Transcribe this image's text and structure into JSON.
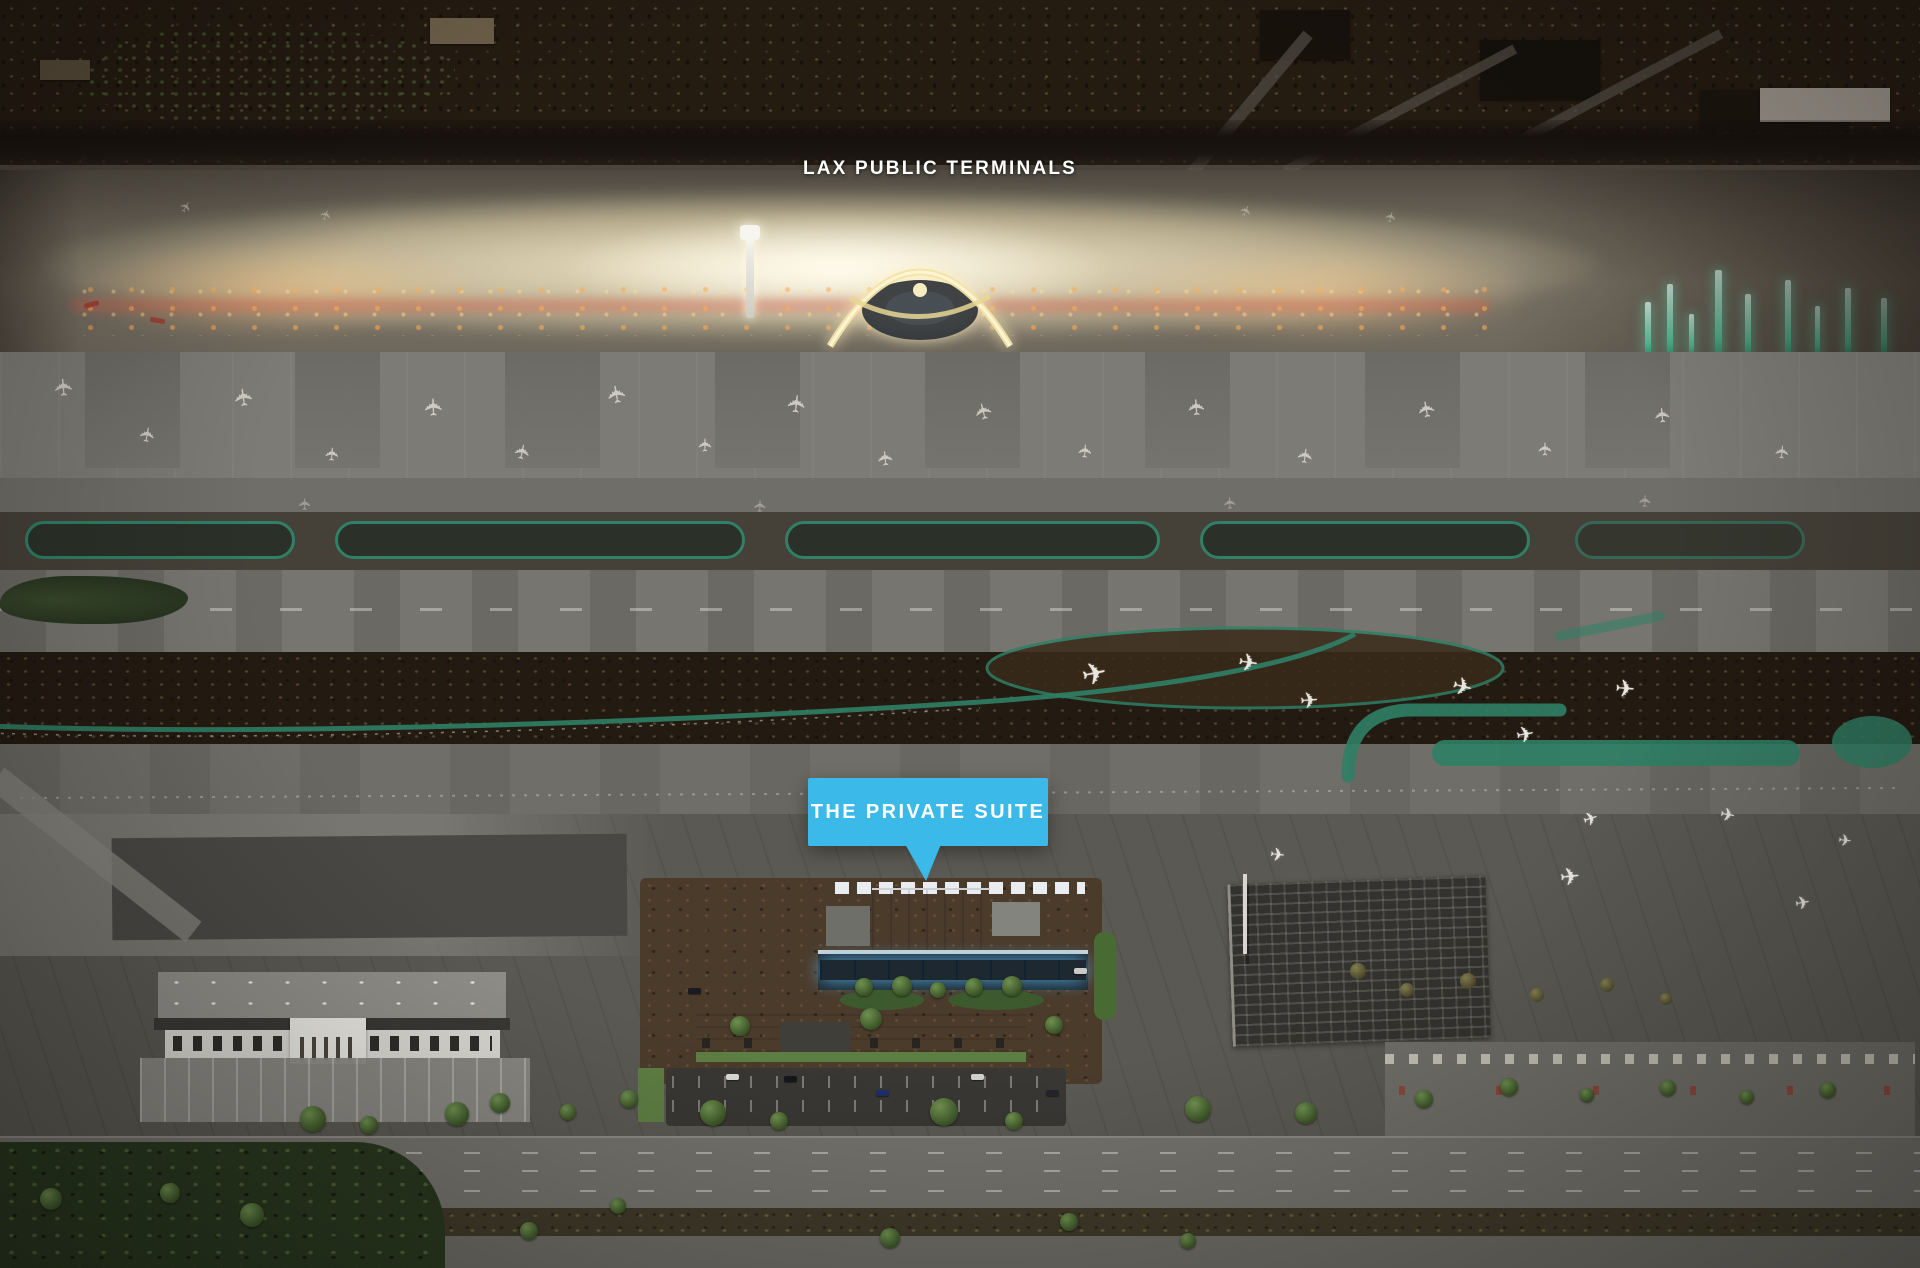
{
  "scene": {
    "type": "aerial-photograph",
    "subject": "Night aerial view of LAX airport with the public terminals in the distance and The Private Suite terminal highlighted in the foreground"
  },
  "annotations": {
    "public_terminals_label": "LAX PUBLIC TERMINALS",
    "private_suite_callout": "THE PRIVATE SUITE"
  },
  "icons": {
    "airplane": "✈"
  },
  "colors": {
    "callout_blue": "#3bb9e9",
    "label_white": "#ffffff",
    "terminal_glow": "#ffeec2",
    "taxiway_teal": "#2f8066",
    "pylon_teal": "#86ecc9",
    "suite_glass_blue": "#5db6ee",
    "tarmac_gray": "#7c7b75",
    "runway_gray": "#76756f",
    "dirt_brown": "#4e3b26",
    "city_dark": "#231a11",
    "vegetation_green": "#3f5230"
  }
}
